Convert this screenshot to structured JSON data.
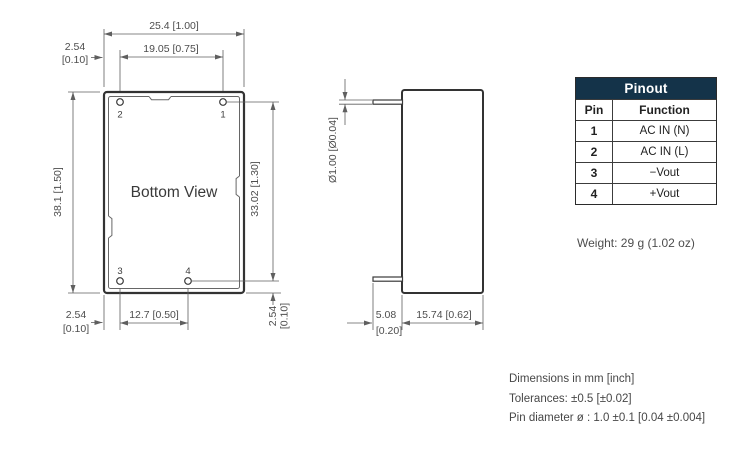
{
  "drawing": {
    "bottom_view": {
      "label": "Bottom View",
      "pin_labels": {
        "top_left": "2",
        "top_right": "1",
        "bottom_left": "3",
        "bottom_mid": "4"
      },
      "dims": {
        "width_outer": "25.4 [1.00]",
        "pin_span_top": "19.05 [0.75]",
        "edge_to_pin_top_mm": "2.54",
        "edge_to_pin_top_inch": "[0.10]",
        "height_outer": "38.1 [1.50]",
        "pin_span_right": "33.02 [1.30]",
        "pin_to_edge_right_mm": "2.54",
        "pin_to_edge_right_inch": "[0.10]",
        "edge_to_pin_bottom_mm": "2.54",
        "edge_to_pin_bottom_inch": "[0.10]",
        "pin_span_bottom": "12.7 [0.50]"
      }
    },
    "side_view": {
      "dims": {
        "pin_diameter": "Ø1.00 [Ø0.04]",
        "pin_length_mm": "5.08",
        "pin_length_inch": "[0.20]",
        "body_depth": "15.74 [0.62]"
      }
    }
  },
  "pinout": {
    "title": "Pinout",
    "columns": [
      "Pin",
      "Function"
    ],
    "rows": [
      [
        "1",
        "AC IN (N)"
      ],
      [
        "2",
        "AC IN (L)"
      ],
      [
        "3",
        "−Vout"
      ],
      [
        "4",
        "+Vout"
      ]
    ]
  },
  "weight": "Weight: 29 g (1.02 oz)",
  "notes": [
    "Dimensions in mm [inch]",
    "Tolerances: ±0.5 [±0.02]",
    "Pin diameter ø : 1.0 ±0.1 [0.04 ±0.004]"
  ],
  "colors": {
    "table_header_bg": "#143349",
    "line": "#5f5f5f",
    "outline": "#333333"
  }
}
